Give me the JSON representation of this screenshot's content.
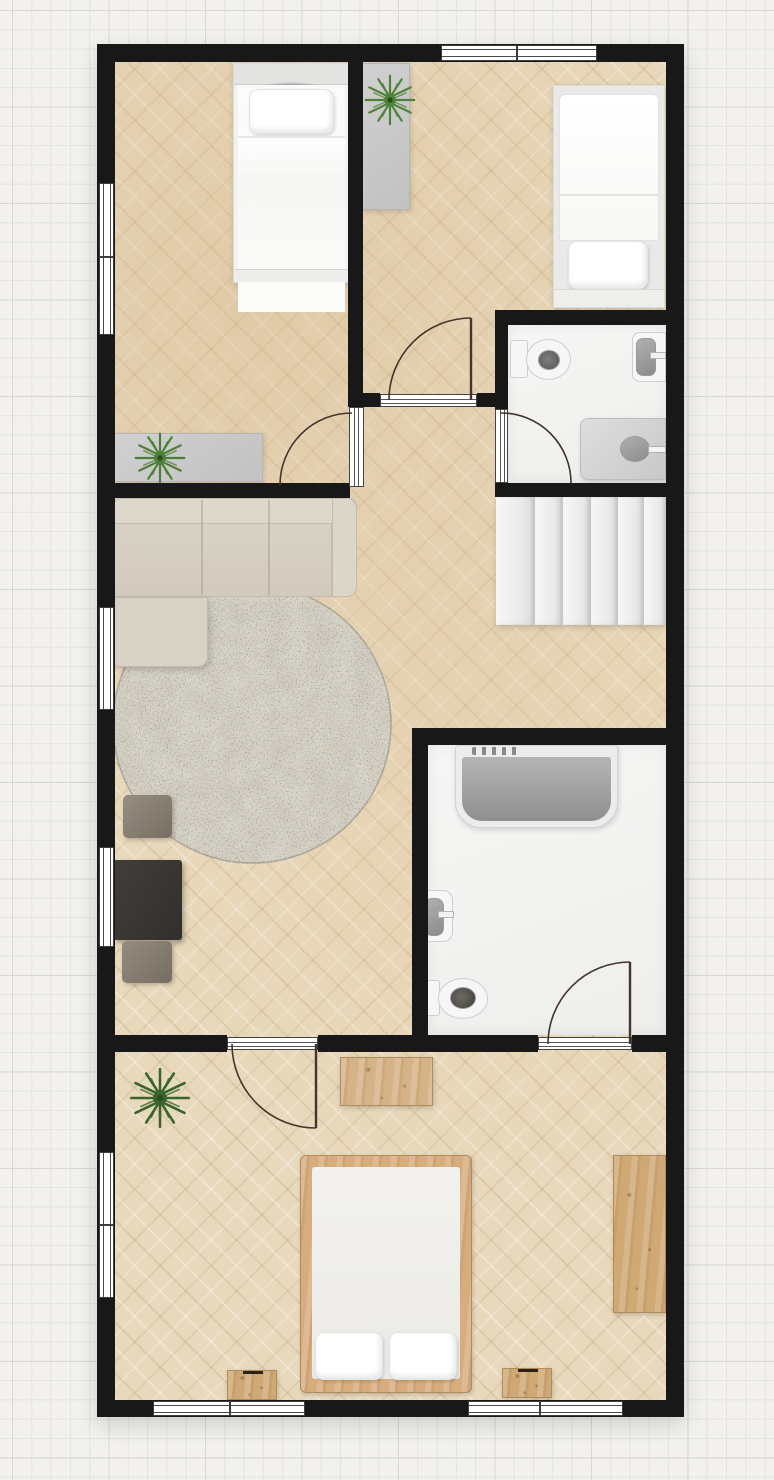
{
  "app": {
    "type": "floor-plan-viewer",
    "view": "2d-top-down",
    "visible_text_on_screen": ""
  },
  "palette": {
    "wall": "#181818",
    "grid_bg": "#f2f1ed",
    "grid_line": "#e4e3de",
    "grid_line_major": "#d8d7d2",
    "wood_floor": "#e9d9bc",
    "bath_floor": "#f4f4f2",
    "sofa": "#d6cfc3",
    "rug_base": "#d8d4c9",
    "wood_furniture": "#d2ab7c",
    "dark_table": "#3a3734",
    "gray_furniture": "#c9c9c9",
    "plant_green": "#4b7f36",
    "plant_dark_green": "#3a682c",
    "fixture_gray": "#9c9c9c",
    "bed_white": "#fafaf9"
  },
  "labels": {
    "plan": "2D floor plan",
    "grid": "Drawing grid",
    "walls": "Walls",
    "bedroom_top_left": "Bedroom (top left)",
    "bedroom_top_right": "Bedroom (top right)",
    "bathroom_small": "Bathroom (small)",
    "bathroom_large": "Bathroom (large)",
    "living_room": "Living room",
    "hallway": "Hallway with staircase",
    "bedroom_bottom": "Bedroom (bottom)",
    "single_bed": "Single bed",
    "double_bed": "Double bed",
    "wardrobe": "Wardrobe",
    "sideboard": "Sideboard",
    "plant": "Potted plant",
    "sofa": "Corner sofa",
    "rug": "Round rug",
    "coffee_table": "Dark coffee table",
    "stool": "Stool",
    "stairs": "Staircase",
    "toilet": "Toilet",
    "sink": "Washbasin",
    "vanity": "Vanity unit",
    "bathtub": "Bathtub",
    "bench": "Wooden bench",
    "desk": "Desk",
    "nightstand": "Nightstand",
    "door": "Interior door",
    "window": "Window"
  },
  "rooms": [
    {
      "id": "bedroom-top-left",
      "furniture": [
        "single-bed",
        "sideboard",
        "plant"
      ]
    },
    {
      "id": "bedroom-top-right",
      "furniture": [
        "single-bed",
        "wardrobe",
        "plant"
      ]
    },
    {
      "id": "bathroom-small",
      "furniture": [
        "toilet",
        "washbasin",
        "vanity-unit"
      ]
    },
    {
      "id": "hallway",
      "furniture": [
        "staircase"
      ]
    },
    {
      "id": "living-room",
      "furniture": [
        "corner-sofa",
        "round-rug",
        "coffee-table",
        "stool",
        "stool"
      ]
    },
    {
      "id": "bathroom-large",
      "furniture": [
        "bathtub",
        "washbasin",
        "toilet"
      ]
    },
    {
      "id": "bedroom-bottom",
      "furniture": [
        "double-bed",
        "nightstand",
        "nightstand",
        "bench",
        "desk",
        "plant"
      ]
    }
  ],
  "openings": {
    "interior_doors": 5,
    "windows": 7,
    "door_swing_style": "quarter-circle arc"
  },
  "stairs": {
    "treads": 6,
    "direction": "horizontal"
  }
}
